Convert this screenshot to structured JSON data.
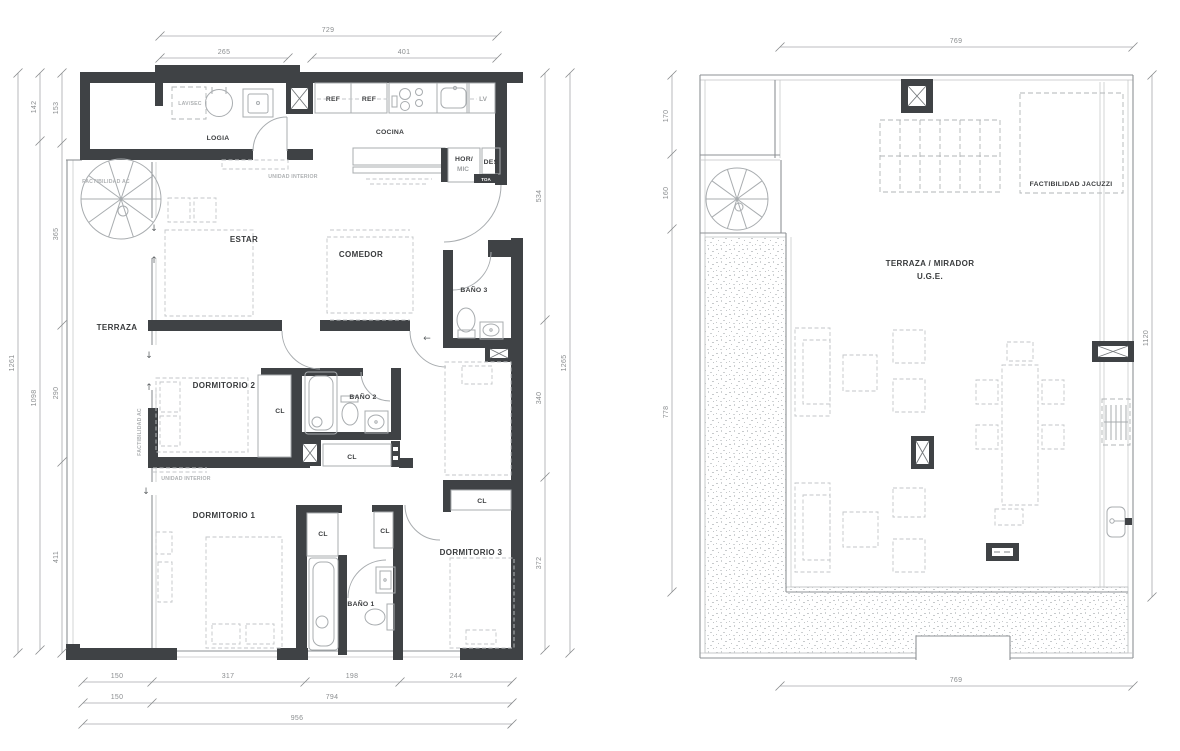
{
  "left_plan": {
    "rooms": {
      "logia": "LOGIA",
      "cocina": "COCINA",
      "estar": "ESTAR",
      "comedor": "COMEDOR",
      "terraza": "TERRAZA",
      "bano3": "BAÑO 3",
      "dorm2": "DORMITORIO 2",
      "bano2": "BAÑO 2",
      "dorm1": "DORMITORIO 1",
      "bano1": "BAÑO 1",
      "dorm3": "DORMITORIO 3",
      "closet": "CL"
    },
    "appliances": {
      "lav_sec": "LAV/SEC",
      "ref": "REF",
      "lv": "LV",
      "hor": "HOR/",
      "mic": "MIC",
      "des": "DES",
      "toa": "TOA"
    },
    "notes": {
      "unidad_interior": "UNIDAD INTERIOR",
      "factibilidad_ac": "FACTIBILIDAD AC"
    },
    "dims": {
      "top_total": "729",
      "top_left": "265",
      "top_right": "401",
      "side_out": "1261",
      "side_mid_top": "142",
      "side_mid_bot": "1098",
      "side_in_1": "153",
      "side_in_2": "365",
      "side_in_3": "290",
      "side_in_4": "411",
      "right_out": "1265",
      "right_1": "534",
      "right_2": "340",
      "right_3": "372",
      "bot_1a": "150",
      "bot_1b": "317",
      "bot_1c": "198",
      "bot_1d": "244",
      "bot_2a": "150",
      "bot_2b": "794",
      "bot_3": "956"
    }
  },
  "right_plan": {
    "rooms": {
      "terraza_mirador": "TERRAZA / MIRADOR",
      "uge": "U.G.E.",
      "jacuzzi": "FACTIBILIDAD JACUZZI"
    },
    "dims": {
      "top": "769",
      "bottom": "769",
      "left_1": "170",
      "left_2": "160",
      "left_3": "778",
      "right": "1120"
    }
  },
  "symbols": {
    "down": "↓",
    "up": "↑",
    "left": "←"
  }
}
